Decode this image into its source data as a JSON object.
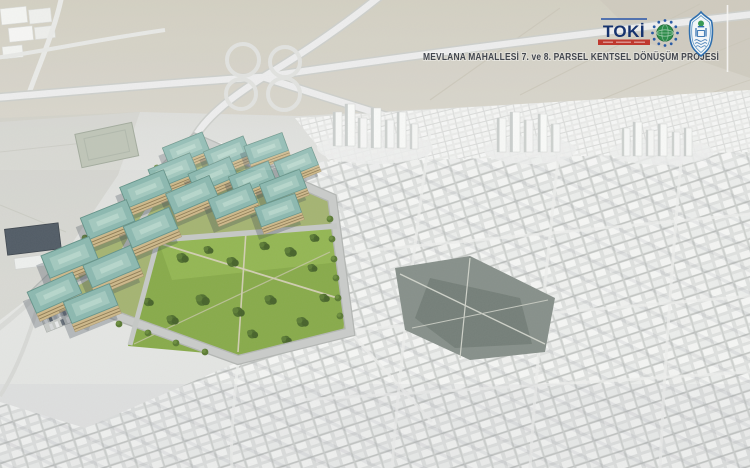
{
  "header": {
    "title": "MEVLANA MAHALLESİ 7. ve 8. PARSEL KENTSEL DÖNÜŞÜM PROJESİ"
  },
  "logos": {
    "toki": {
      "label": "TOKİ"
    },
    "globe_emblem": "green-globe-with-blue-stars",
    "municipal_emblem": "blue-mosque-shield"
  },
  "scene": {
    "description_elements": {
      "rendered_site": "apartment-blocks-with-teal-roofs-and-park",
      "background": "grayscale-aerial-city-photo"
    }
  },
  "colors": {
    "roof_teal": "#8cb9b0",
    "facade_cream": "#d8c89e",
    "grass_green": "#88ab4a",
    "road_gray": "#caccca",
    "photo_light": "#e9eae8",
    "title_text": "#43474f",
    "toki_navy": "#16336e",
    "toki_red": "#bf392f",
    "emblem_blue": "#2f6fae",
    "emblem_green": "#2e8c4a"
  }
}
